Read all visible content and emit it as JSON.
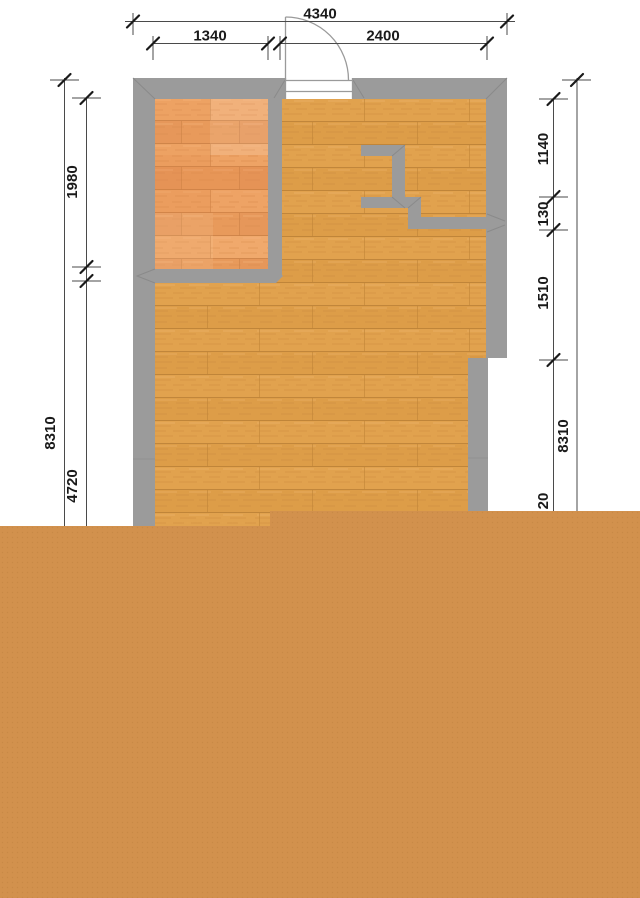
{
  "title": "apartment-floor-plan",
  "colors": {
    "canvas_bg": "#ffffff",
    "wall": "#9b9b9b",
    "wall_edge": "#8a8a8a",
    "floor_main": "#e1a24e",
    "floor_room": "#eda263",
    "overlay": "#d2914d",
    "overlay_dot": "#bc7f3e",
    "dim_line": "#4a4a4a",
    "tick": "#1a1a1a",
    "text": "#1a1a1a",
    "door": "#9a9a9a"
  },
  "dimensions": {
    "top_overall": "4340",
    "top_left": "1340",
    "top_right": "2400",
    "left_overall": "8310",
    "left_upper": "1980",
    "left_lower": "4720",
    "right_overall": "8310",
    "right_top": "1140",
    "right_mid": "130",
    "right_lower": "1510",
    "right_partial": "20"
  }
}
